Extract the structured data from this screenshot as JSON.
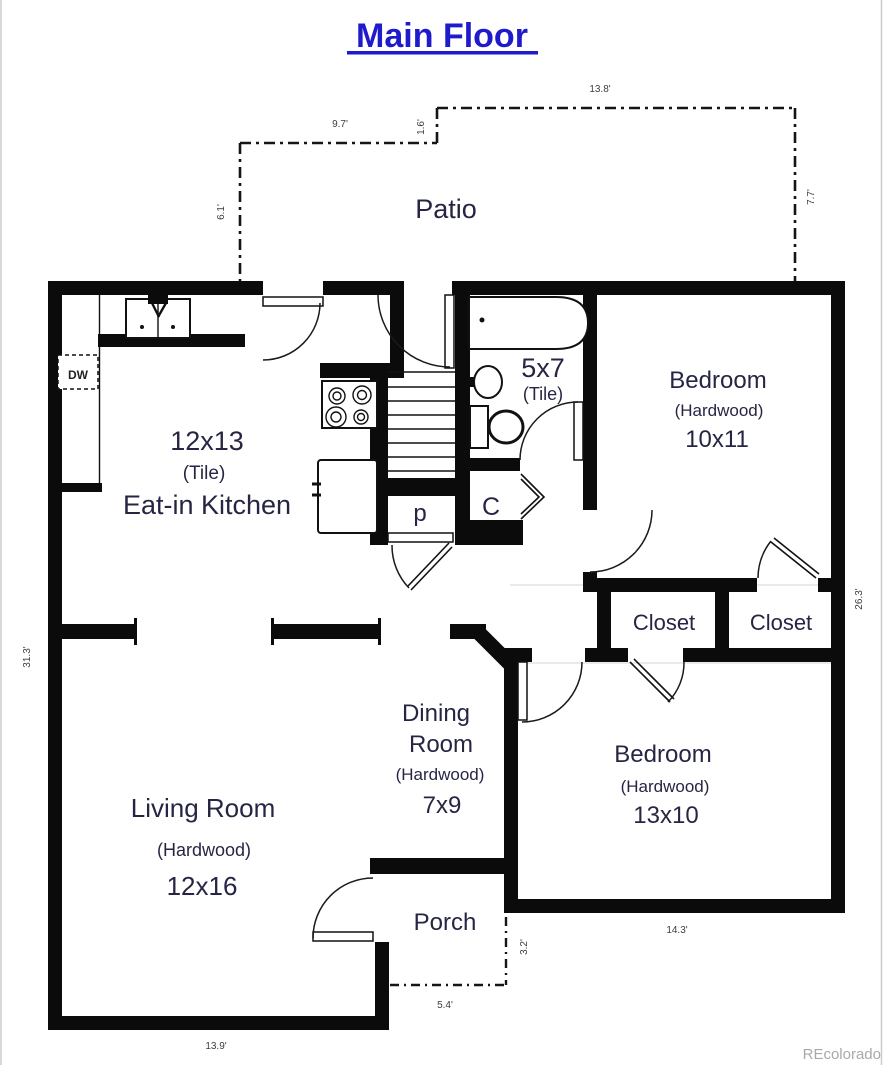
{
  "title": "Main Floor",
  "watermark": "REcolorado",
  "rooms": {
    "patio": {
      "name": "Patio"
    },
    "kitchen": {
      "size": "12x13",
      "floor": "(Tile)",
      "name": "Eat-in Kitchen"
    },
    "bathroom": {
      "size": "5x7",
      "floor": "(Tile)"
    },
    "bedroom1": {
      "name": "Bedroom",
      "floor": "(Hardwood)",
      "size": "10x11"
    },
    "closet_left": {
      "name": "Closet"
    },
    "closet_right": {
      "name": "Closet"
    },
    "pantry": {
      "label": "p"
    },
    "hall_closet": {
      "label": "C"
    },
    "dining": {
      "line1": "Dining",
      "line2": "Room",
      "floor": "(Hardwood)",
      "size": "7x9"
    },
    "bedroom2": {
      "name": "Bedroom",
      "floor": "(Hardwood)",
      "size": "13x10"
    },
    "living": {
      "name": "Living Room",
      "floor": "(Hardwood)",
      "size": "12x16"
    },
    "porch": {
      "name": "Porch"
    }
  },
  "appliances": {
    "dishwasher": "DW"
  },
  "dimensions": {
    "patio_top": "13.8'",
    "patio_upper_left": "9.7'",
    "patio_jog": "1.6'",
    "patio_left": "6.1'",
    "patio_right": "7.7'",
    "right_side": "26.3'",
    "left_side": "31.3'",
    "bedroom2_width": "14.3'",
    "porch_depth": "3.2'",
    "porch_width": "5.4'",
    "living_width": "13.9'"
  },
  "colors": {
    "title": "#1f1acb",
    "room_label": "#262644",
    "dimension_label": "#3d3d3d",
    "wall": "#0b0b0b",
    "watermark": "#a9a9a9"
  }
}
